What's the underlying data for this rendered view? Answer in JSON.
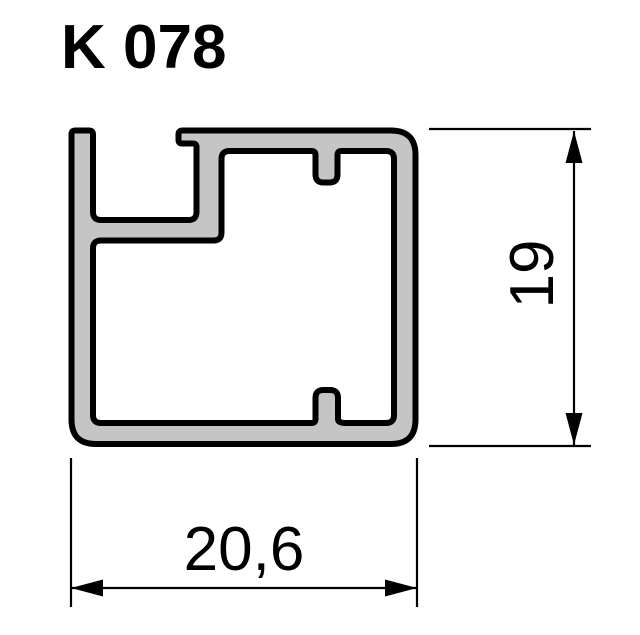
{
  "header": {
    "title": "K 078"
  },
  "drawing": {
    "type": "profile-cross-section",
    "profile_fill_color": "#c5c5c5",
    "outline_color": "#000000",
    "dimension_color": "#000000",
    "height_dimension": {
      "label": "19"
    },
    "width_dimension": {
      "label": "20,6"
    }
  }
}
